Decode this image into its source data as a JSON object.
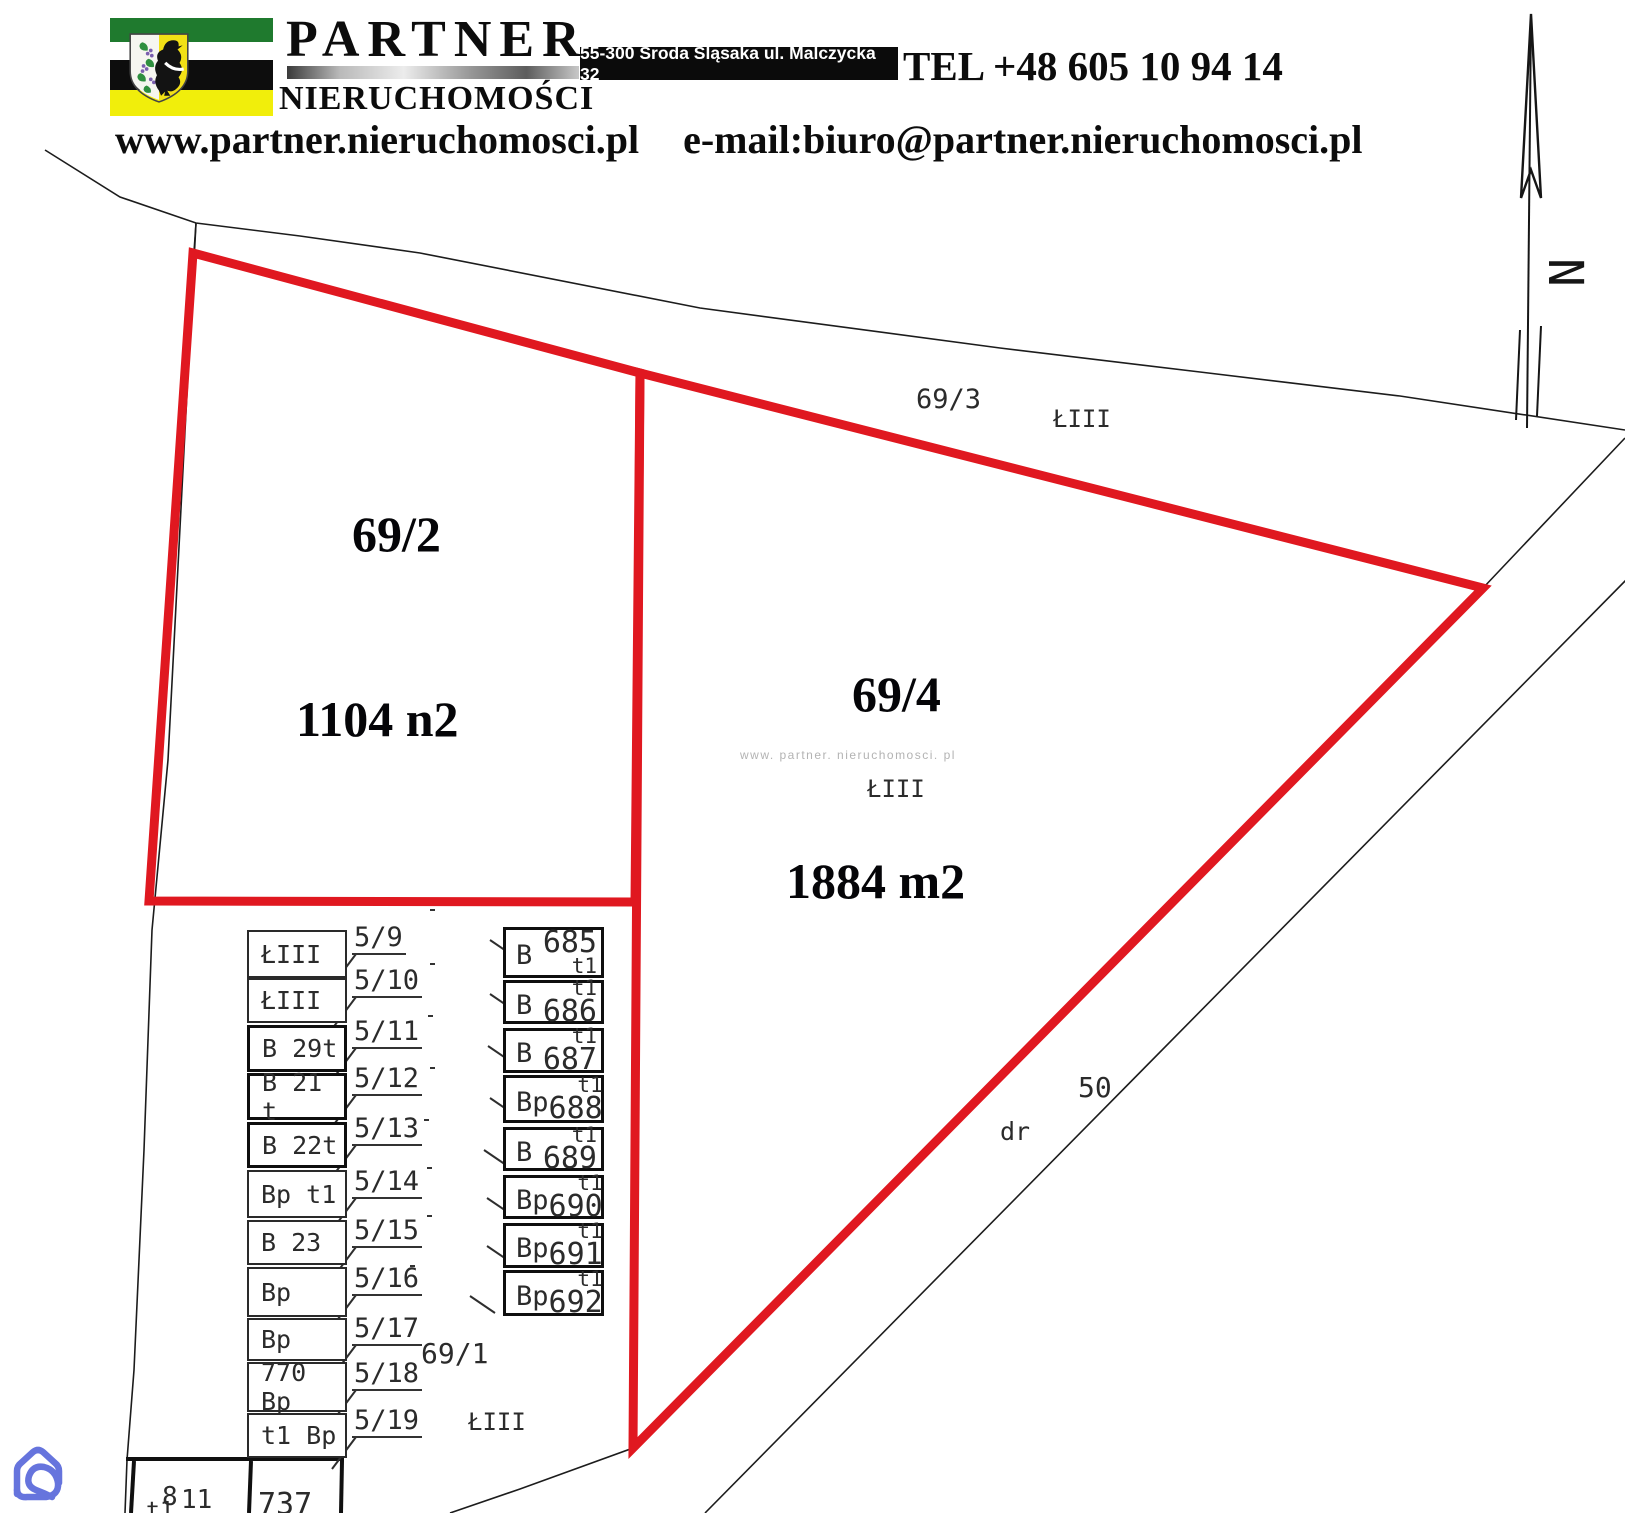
{
  "header": {
    "brand_top": "PARTNER",
    "brand_bottom": "NIERUCHOMOŚCI",
    "address": "55-300 Środa Śląsaka  ul. Malczycka 32",
    "phone": "TEL +48 605 10 94 14",
    "website": "www.partner.nieruchomosci.pl",
    "email": "e-mail:biuro@partner.nieruchomosci.pl"
  },
  "colors": {
    "highlight_red": "#e01820",
    "flag_green": "#1f7a2e",
    "flag_white": "#ffffff",
    "flag_black": "#0d0d0d",
    "flag_yellow": "#f1ee0b",
    "watermark_blue": "#6674dd"
  },
  "map": {
    "north_symbol": "N",
    "watermark": {
      "text": "www. partner. nieruchomosci. pl",
      "x": 740,
      "y": 748
    },
    "highlighted_plots": [
      {
        "id": "69/2",
        "area": "1104 n2"
      },
      {
        "id": "69/4",
        "area": "1884 m2"
      }
    ],
    "big_labels": [
      {
        "text": "69/2",
        "x": 352,
        "y": 505
      },
      {
        "text": "1104 n2",
        "x": 296,
        "y": 690
      },
      {
        "text": "69/4",
        "x": 852,
        "y": 665
      },
      {
        "text": "1884 m2",
        "x": 786,
        "y": 852
      }
    ],
    "labels": [
      {
        "text": "69/3",
        "x": 916,
        "y": 384,
        "s": 27
      },
      {
        "text": "ŁIII",
        "x": 1053,
        "y": 405,
        "s": 24
      },
      {
        "text": "ŁIII",
        "x": 867,
        "y": 775,
        "s": 24
      },
      {
        "text": "69/1",
        "x": 421,
        "y": 1337,
        "s": 28
      },
      {
        "text": "ŁIII",
        "x": 468,
        "y": 1408,
        "s": 24
      },
      {
        "text": "50",
        "x": 1078,
        "y": 1071,
        "s": 28
      },
      {
        "text": "dr",
        "x": 1000,
        "y": 1117,
        "s": 25
      },
      {
        "text": "t1",
        "x": 146,
        "y": 1498,
        "s": 23
      },
      {
        "text": "8",
        "x": 162,
        "y": 1482,
        "s": 26
      },
      {
        "text": "11",
        "x": 181,
        "y": 1485,
        "s": 26
      },
      {
        "text": "737",
        "x": 258,
        "y": 1487,
        "s": 30
      }
    ],
    "left_label_x": 352,
    "left_rows": [
      {
        "text": "ŁIII",
        "label": "5/9",
        "y": 930,
        "h": 48,
        "label_y": 922,
        "thick": false
      },
      {
        "text": "ŁIII",
        "label": "5/10",
        "y": 978,
        "h": 45,
        "label_y": 965,
        "thick": false
      },
      {
        "text": "B 29t",
        "label": "5/11",
        "y": 1025,
        "h": 47,
        "label_y": 1016,
        "thick": true
      },
      {
        "text": "B 21 t",
        "label": "5/12",
        "y": 1073,
        "h": 47,
        "label_y": 1063,
        "thick": true
      },
      {
        "text": "B 22t",
        "label": "5/13",
        "y": 1122,
        "h": 46,
        "label_y": 1113,
        "thick": true
      },
      {
        "text": "Bp t1",
        "label": "5/14",
        "y": 1170,
        "h": 48,
        "label_y": 1166,
        "thick": false
      },
      {
        "text": "B 23",
        "label": "5/15",
        "y": 1220,
        "h": 45,
        "label_y": 1215,
        "thick": false
      },
      {
        "text": "Bp",
        "label": "5/16",
        "y": 1267,
        "h": 50,
        "label_y": 1263,
        "thick": false
      },
      {
        "text": "Bp",
        "label": "5/17",
        "y": 1318,
        "h": 43,
        "label_y": 1313,
        "thick": false
      },
      {
        "text": "770 Bp",
        "label": "5/18",
        "y": 1362,
        "h": 50,
        "label_y": 1358,
        "thick": false
      },
      {
        "text": "t1 Bp",
        "label": "5/19",
        "y": 1413,
        "h": 45,
        "label_y": 1405,
        "thick": false
      }
    ],
    "right_cells": [
      {
        "letter": "B",
        "t": "t1",
        "num": "685",
        "num_top": true,
        "y": 927,
        "h": 51,
        "lx": 430,
        "ly": 909
      },
      {
        "letter": "B",
        "t": "t1",
        "num": "686",
        "num_top": false,
        "y": 980,
        "h": 44,
        "lx": 430,
        "ly": 963
      },
      {
        "letter": "B",
        "t": "t1",
        "num": "687",
        "num_top": false,
        "y": 1028,
        "h": 45,
        "lx": 428,
        "ly": 1015
      },
      {
        "letter": "Bp",
        "t": "t1",
        "num": "688",
        "num_top": false,
        "y": 1075,
        "h": 48,
        "lx": 430,
        "ly": 1067
      },
      {
        "letter": "B",
        "t": "t1",
        "num": "689",
        "num_top": false,
        "y": 1127,
        "h": 44,
        "lx": 424,
        "ly": 1119
      },
      {
        "letter": "Bp",
        "t": "t1",
        "num": "690",
        "num_top": false,
        "y": 1175,
        "h": 44,
        "lx": 427,
        "ly": 1167
      },
      {
        "letter": "Bp",
        "t": "t1",
        "num": "691",
        "num_top": false,
        "y": 1223,
        "h": 45,
        "lx": 427,
        "ly": 1215
      },
      {
        "letter": "Bp",
        "t": "t1",
        "num": "692",
        "num_top": false,
        "y": 1270,
        "h": 46,
        "lx": 410,
        "ly": 1265
      }
    ]
  }
}
